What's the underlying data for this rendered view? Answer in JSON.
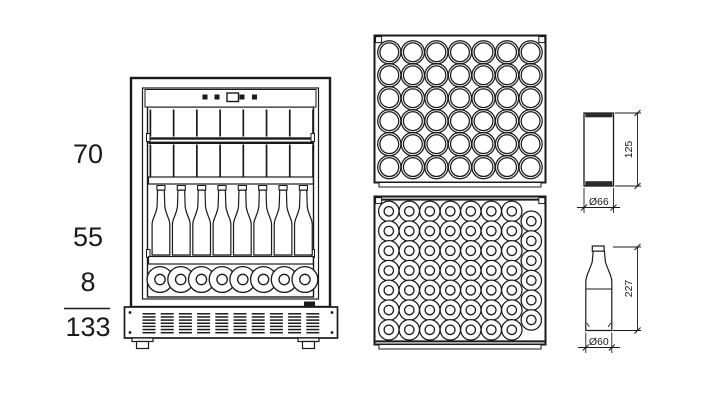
{
  "style": {
    "background": "#ffffff",
    "line_color": "#1a1a1a",
    "text_color": "#1a1a1a"
  },
  "capacity_summary": {
    "cans": "70",
    "standing_bottles": "55",
    "lying_bottles": "8",
    "total": "133"
  },
  "can_spec": {
    "height": "125",
    "diameter": "Ø66"
  },
  "bottle_spec": {
    "height": "227",
    "diameter": "Ø60"
  },
  "fridge_front": {
    "can_columns": 7,
    "standing_bottles": 8,
    "lying_bottles": 8,
    "vent_groups": 10
  },
  "can_tray_top_view": {
    "columns": 7,
    "rows": 6
  },
  "bottle_tray_top_view": {
    "columns": 7,
    "rows": 7,
    "staggered_right_column": 6
  }
}
